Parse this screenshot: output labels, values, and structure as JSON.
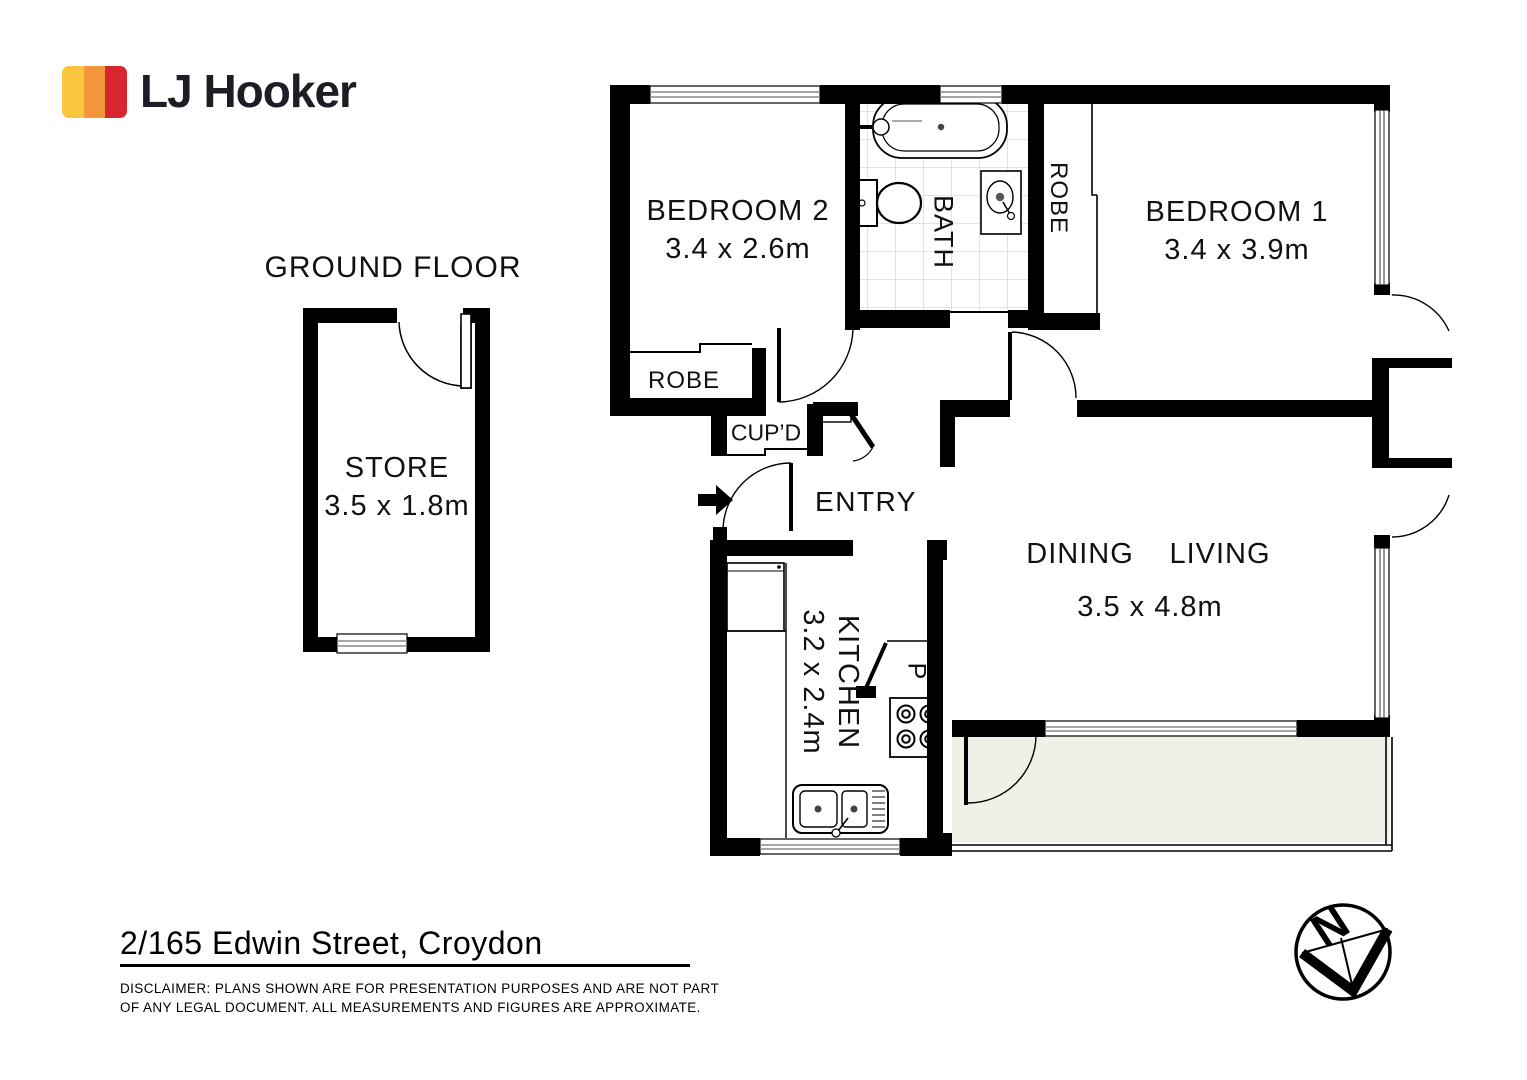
{
  "brand": {
    "name": "LJ Hooker",
    "bar_colors": [
      "#FBC540",
      "#F2953B",
      "#D7272E"
    ],
    "text_color": "#1D1D25"
  },
  "plan": {
    "floor_label": "GROUND FLOOR",
    "rooms": {
      "store": {
        "name": "STORE",
        "dims": "3.5 x 1.8m"
      },
      "bedroom2": {
        "name": "BEDROOM 2",
        "dims": "3.4 x 2.6m"
      },
      "bedroom1": {
        "name": "BEDROOM 1",
        "dims": "3.4 x 3.9m"
      },
      "bath": {
        "name": "BATH"
      },
      "robe_bedroom1": {
        "name": "ROBE"
      },
      "robe_bedroom2": {
        "name": "ROBE"
      },
      "cupboard": {
        "name": "CUP’D"
      },
      "entry": {
        "name": "ENTRY"
      },
      "kitchen": {
        "name": "KITCHEN",
        "dims": "3.2 x 2.4m"
      },
      "dining": {
        "name": "DINING"
      },
      "living": {
        "name": "LIVING",
        "dims": "3.5 x 4.8m"
      },
      "pantry": {
        "abbr": "P"
      }
    },
    "compass": {
      "label": "N"
    },
    "colors": {
      "wall": "#000000",
      "balcony_fill": "#F1F0E6",
      "tile_line": "#DBDBDB"
    }
  },
  "footer": {
    "address": "2/165 Edwin Street, Croydon",
    "disclaimer_line1": "DISCLAIMER:  PLANS SHOWN ARE FOR PRESENTATION PURPOSES AND ARE NOT PART",
    "disclaimer_line2": "OF ANY LEGAL DOCUMENT. ALL MEASUREMENTS AND FIGURES ARE APPROXIMATE."
  }
}
